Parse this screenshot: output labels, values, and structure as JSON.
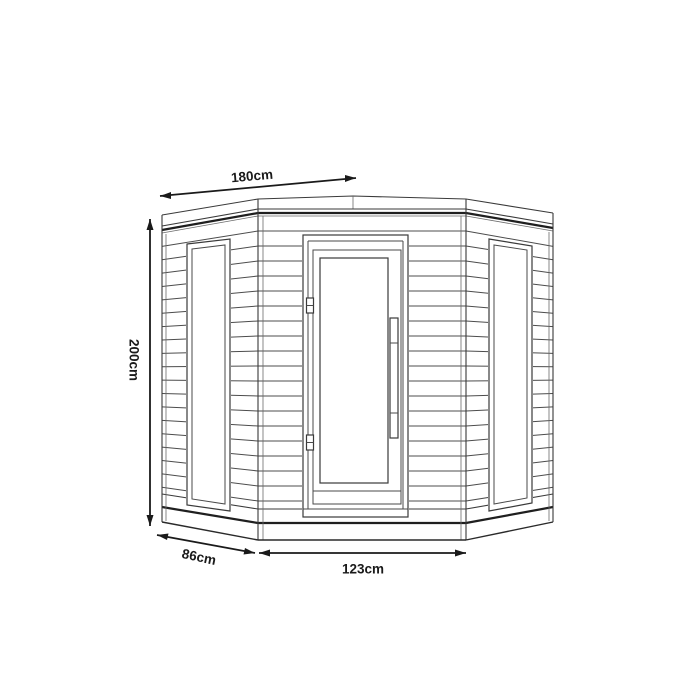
{
  "diagram": {
    "subject": "corner-cabin-technical-drawing",
    "background_color": "#ffffff",
    "line_color": "#3a3a3a",
    "dimension_color": "#1a1a1a"
  },
  "dimensions": {
    "roof_width": {
      "label": "180cm",
      "orientation": "diagonal-top"
    },
    "height": {
      "label": "200cm",
      "orientation": "vertical-left"
    },
    "side_depth": {
      "label": "86cm",
      "orientation": "diagonal-bottom-left"
    },
    "front_width": {
      "label": "123cm",
      "orientation": "horizontal-bottom"
    }
  }
}
